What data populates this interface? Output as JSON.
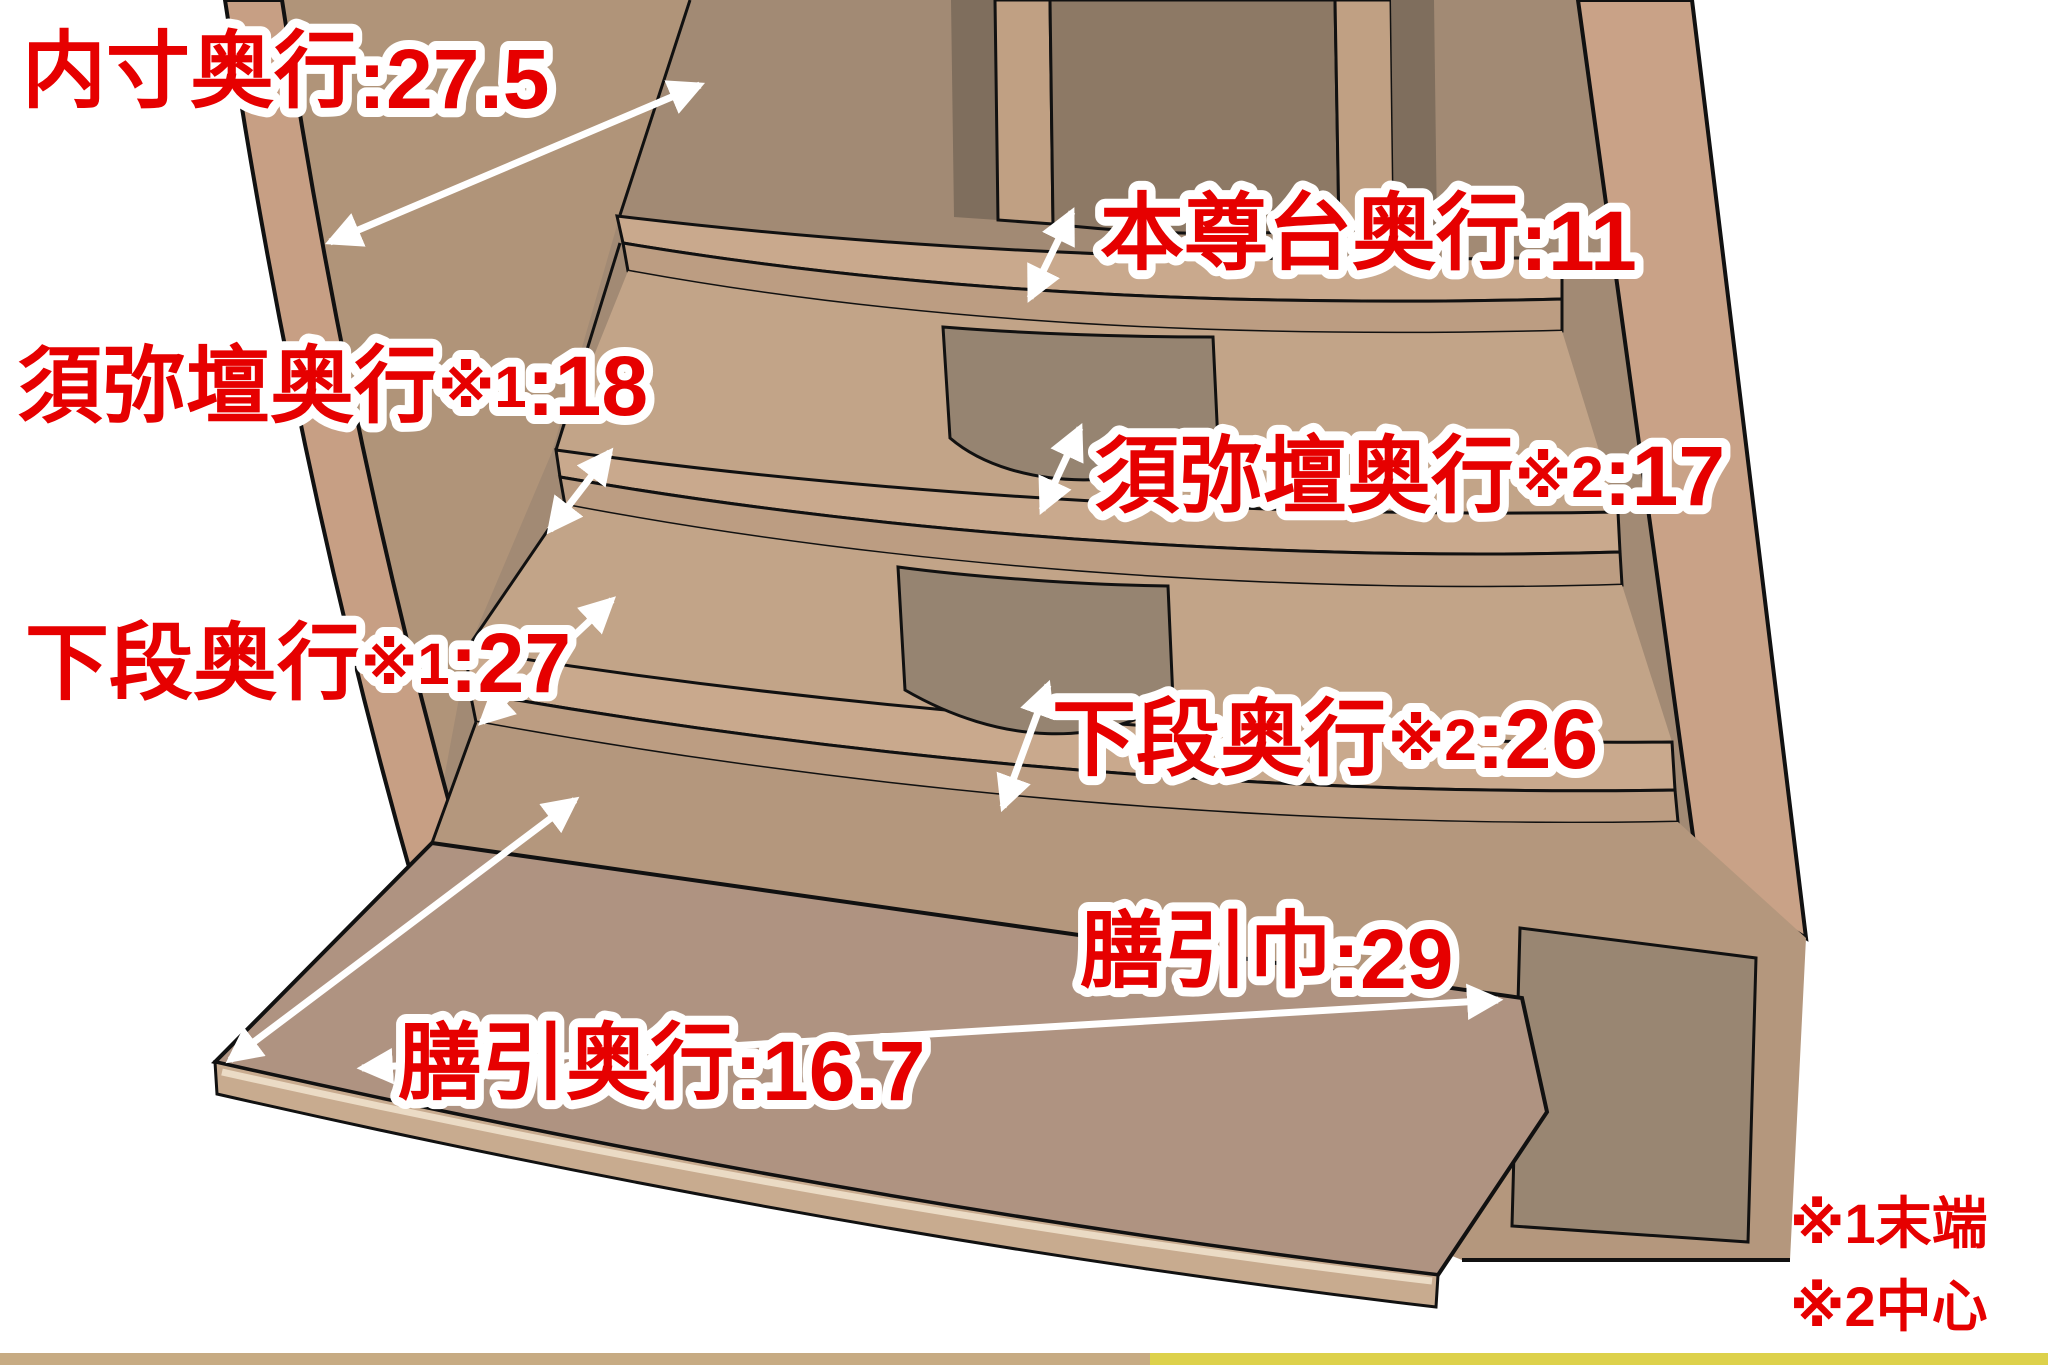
{
  "diagram": {
    "subject": "仏壇 内部奥行き寸法図",
    "accent_color": "#e60000",
    "label_outline_color": "#ffffff"
  },
  "labels": {
    "uchinori": {
      "prefix": "内寸奥行",
      "marker": "",
      "value": ":27.5"
    },
    "honzondai": {
      "prefix": "本尊台奥行",
      "marker": "",
      "value": ":11"
    },
    "shumidan_end": {
      "prefix": "須弥壇奥行",
      "marker": "※1",
      "value": ":18"
    },
    "shumidan_center": {
      "prefix": "須弥壇奥行",
      "marker": "※2",
      "value": ":17"
    },
    "gedan_end": {
      "prefix": "下段奥行",
      "marker": "※1",
      "value": ":27"
    },
    "gedan_center": {
      "prefix": "下段奥行",
      "marker": "※2",
      "value": ":26"
    },
    "zenbiki_width": {
      "prefix": "膳引巾",
      "marker": "",
      "value": ":29"
    },
    "zenbiki_depth": {
      "prefix": "膳引奥行",
      "marker": "",
      "value": ":16.7"
    }
  },
  "footnotes": {
    "note1": "※1末端",
    "note2": "※2中心"
  },
  "measurements": [
    {
      "label": "内寸奥行",
      "reference": "",
      "value": 27.5
    },
    {
      "label": "本尊台奥行",
      "reference": "",
      "value": 11
    },
    {
      "label": "須弥壇奥行",
      "reference": "※1",
      "value": 18
    },
    {
      "label": "須弥壇奥行",
      "reference": "※2",
      "value": 17
    },
    {
      "label": "下段奥行",
      "reference": "※1",
      "value": 27
    },
    {
      "label": "下段奥行",
      "reference": "※2",
      "value": 26
    },
    {
      "label": "膳引巾",
      "reference": "",
      "value": 29
    },
    {
      "label": "膳引奥行",
      "reference": "",
      "value": 16.7
    }
  ],
  "palette": {
    "back_wall": "#a28a74",
    "niche_dark": "#8d7965",
    "divider_face": "#c0a083",
    "divider_shadow": "#7f6e5d",
    "left_panel": "#c79f84",
    "left_inner_wall": "#b09479",
    "step_surface": "#c9a98d",
    "step_fascia": "#bc9d82",
    "riser_flank": "#c2a488",
    "riser_dark": "#968471",
    "rail_face": "#b4977d",
    "tray_top": "#af9381",
    "tray_fascia": "#c8ab8f",
    "door_panel": "#998672",
    "arrow_color": "#ffffff",
    "outline_color": "#111111"
  }
}
